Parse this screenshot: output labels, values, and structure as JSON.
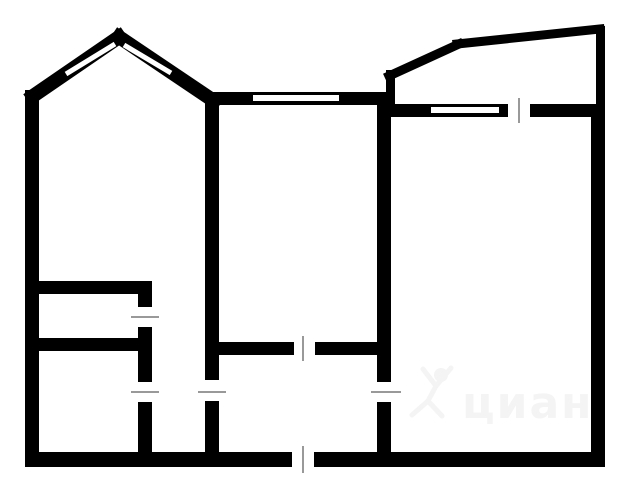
{
  "title": "apartment-floor-plan",
  "canvas": {
    "width": 640,
    "height": 480,
    "background": "#ffffff"
  },
  "palette": {
    "wall": "#000000",
    "window": "#ffffff",
    "door_tick": "#999999",
    "watermark": "#f4f4f4"
  },
  "floorplan": {
    "wall_rects": [
      {
        "name": "left-outer-wall",
        "x": 25,
        "y": 90,
        "w": 14,
        "h": 377
      },
      {
        "name": "bottom-wall-left",
        "x": 25,
        "y": 452,
        "w": 267,
        "h": 15
      },
      {
        "name": "bottom-wall-right",
        "x": 314,
        "y": 452,
        "w": 291,
        "h": 15
      },
      {
        "name": "right-wall-balcony",
        "x": 596,
        "y": 26,
        "w": 9,
        "h": 82
      },
      {
        "name": "right-outer-wall",
        "x": 591,
        "y": 104,
        "w": 14,
        "h": 363
      },
      {
        "name": "top-wall-livingroom",
        "x": 205,
        "y": 92,
        "w": 187,
        "h": 13
      },
      {
        "name": "wall-left-vertical-upper",
        "x": 205,
        "y": 94,
        "w": 14,
        "h": 286
      },
      {
        "name": "wall-left-vertical-lower",
        "x": 205,
        "y": 401,
        "w": 14,
        "h": 52
      },
      {
        "name": "wall-right-vertical-upper",
        "x": 377,
        "y": 92,
        "w": 14,
        "h": 290
      },
      {
        "name": "wall-right-vertical-lower",
        "x": 377,
        "y": 402,
        "w": 14,
        "h": 51
      },
      {
        "name": "balcony-floor-wall-left",
        "x": 388,
        "y": 104,
        "w": 120,
        "h": 13
      },
      {
        "name": "balcony-floor-wall-right",
        "x": 530,
        "y": 104,
        "w": 75,
        "h": 13
      },
      {
        "name": "balcony-left-wall",
        "x": 386,
        "y": 70,
        "w": 9,
        "h": 37
      },
      {
        "name": "toilet-top-wall",
        "x": 25,
        "y": 281,
        "w": 127,
        "h": 13
      },
      {
        "name": "toilet-door-stub",
        "x": 138,
        "y": 293,
        "w": 14,
        "h": 14
      },
      {
        "name": "bath-partition-mid",
        "x": 138,
        "y": 327,
        "w": 14,
        "h": 55
      },
      {
        "name": "bath-partition-lower",
        "x": 138,
        "y": 402,
        "w": 14,
        "h": 50
      },
      {
        "name": "toilet-bottom-wall",
        "x": 25,
        "y": 338,
        "w": 127,
        "h": 13
      },
      {
        "name": "hall-top-wall-left",
        "x": 212,
        "y": 342,
        "w": 82,
        "h": 13
      },
      {
        "name": "hall-top-wall-right",
        "x": 315,
        "y": 342,
        "w": 76,
        "h": 13
      }
    ],
    "diagonal_walls": [
      {
        "name": "bay-wall-left",
        "x1": 33,
        "y1": 96,
        "x2": 119,
        "y2": 37,
        "t": 14
      },
      {
        "name": "bay-wall-right",
        "x1": 119,
        "y1": 37,
        "x2": 214,
        "y2": 101,
        "t": 14
      },
      {
        "name": "balcony-wall-slope",
        "x1": 389,
        "y1": 76,
        "x2": 459,
        "y2": 44,
        "t": 9
      },
      {
        "name": "balcony-wall-top",
        "x1": 457,
        "y1": 44,
        "x2": 600,
        "y2": 29,
        "t": 9
      }
    ],
    "window_slits": [
      {
        "name": "bay-window-left",
        "x1": 66,
        "y1": 74,
        "x2": 115,
        "y2": 44,
        "t": 5
      },
      {
        "name": "bay-window-right",
        "x1": 124,
        "y1": 45,
        "x2": 171,
        "y2": 73,
        "t": 5
      },
      {
        "name": "livingroom-window",
        "x1": 253,
        "y1": 98,
        "x2": 339,
        "y2": 98,
        "t": 6
      },
      {
        "name": "balcony-window",
        "x1": 431,
        "y1": 110,
        "x2": 499,
        "y2": 110,
        "t": 6
      }
    ],
    "door_ticks": [
      {
        "name": "balcony-door-tick",
        "x1": 519,
        "y1": 98,
        "x2": 519,
        "y2": 123
      },
      {
        "name": "livingroom-door-tick",
        "x1": 303,
        "y1": 336,
        "x2": 303,
        "y2": 361
      },
      {
        "name": "entry-door-tick",
        "x1": 303,
        "y1": 446,
        "x2": 303,
        "y2": 473
      },
      {
        "name": "toilet-door-tick",
        "x1": 131,
        "y1": 317,
        "x2": 159,
        "y2": 317
      },
      {
        "name": "bathroom-door-tick",
        "x1": 131,
        "y1": 392,
        "x2": 159,
        "y2": 392
      },
      {
        "name": "corridor-opening-tick",
        "x1": 198,
        "y1": 392,
        "x2": 226,
        "y2": 392
      },
      {
        "name": "room-door-tick",
        "x1": 371,
        "y1": 392,
        "x2": 401,
        "y2": 392
      }
    ]
  },
  "watermark": {
    "text": "циан",
    "icon": "cian-person-icon",
    "head": {
      "cx": 441,
      "cy": 375,
      "r": 7
    },
    "strokes": [
      {
        "x1": 436,
        "y1": 386,
        "x2": 423,
        "y2": 369
      },
      {
        "x1": 436,
        "y1": 386,
        "x2": 451,
        "y2": 368
      },
      {
        "x1": 436,
        "y1": 386,
        "x2": 428,
        "y2": 401
      },
      {
        "x1": 428,
        "y1": 401,
        "x2": 412,
        "y2": 415
      },
      {
        "x1": 428,
        "y1": 401,
        "x2": 442,
        "y2": 416
      }
    ],
    "text_x": 462,
    "text_y": 418,
    "font_size": 44
  }
}
